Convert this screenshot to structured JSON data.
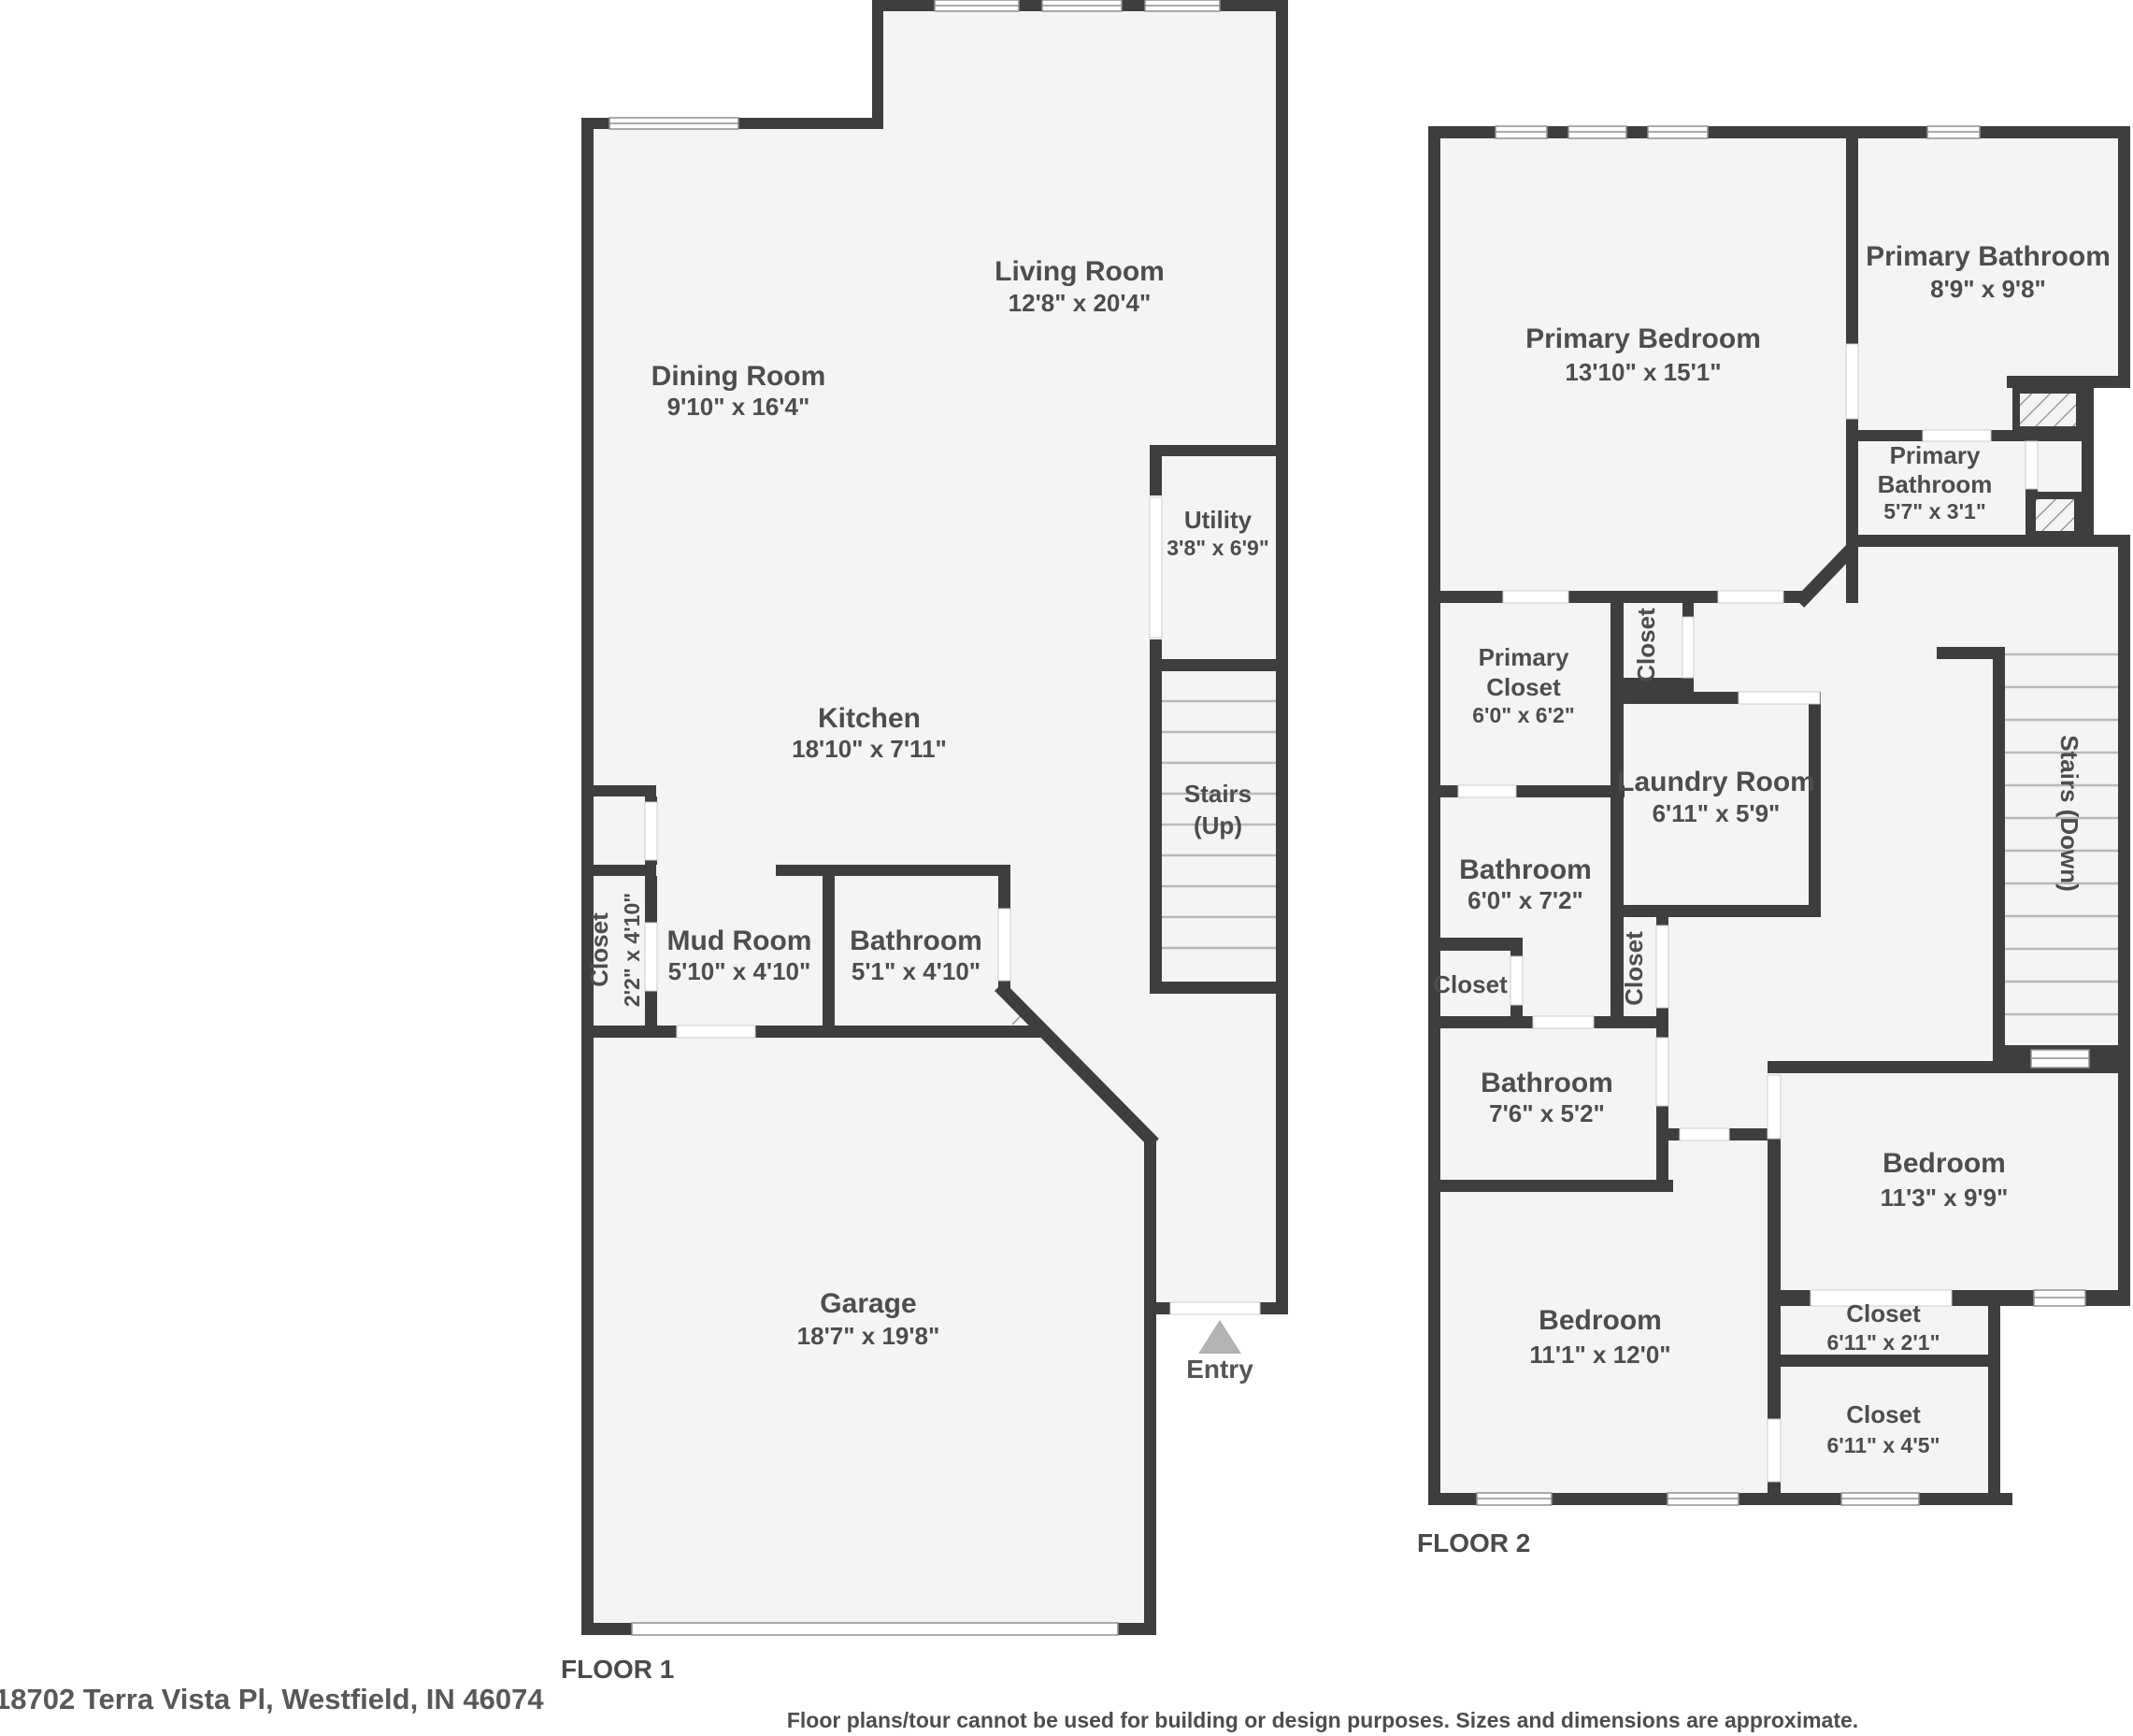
{
  "floor1": {
    "label": "FLOOR 1",
    "rooms": {
      "living": {
        "name": "Living Room",
        "dims": "12'8\" x 20'4\""
      },
      "dining": {
        "name": "Dining Room",
        "dims": "9'10\" x 16'4\""
      },
      "kitchen": {
        "name": "Kitchen",
        "dims": "18'10\" x 7'11\""
      },
      "utility": {
        "name": "Utility",
        "dims": "3'8\" x 6'9\""
      },
      "stairs": {
        "line1": "Stairs",
        "line2": "(Up)"
      },
      "closet": {
        "name": "Closet",
        "dims": "2'2\" x 4'10\""
      },
      "mud": {
        "name": "Mud Room",
        "dims": "5'10\" x 4'10\""
      },
      "bath": {
        "name": "Bathroom",
        "dims": "5'1\" x 4'10\""
      },
      "garage": {
        "name": "Garage",
        "dims": "18'7\" x 19'8\""
      },
      "entry": {
        "name": "Entry"
      }
    }
  },
  "floor2": {
    "label": "FLOOR 2",
    "rooms": {
      "primary_bedroom": {
        "name": "Primary Bedroom",
        "dims": "13'10\" x 15'1\""
      },
      "primary_bath1": {
        "name": "Primary Bathroom",
        "dims": "8'9\" x 9'8\""
      },
      "primary_bath2": {
        "line1": "Primary",
        "line2": "Bathroom",
        "dims": "5'7\" x 3'1\""
      },
      "primary_closet": {
        "line1": "Primary",
        "line2": "Closet",
        "dims": "6'0\" x 6'2\""
      },
      "closet_upper": {
        "name": "Closet"
      },
      "laundry": {
        "name": "Laundry Room",
        "dims": "6'11\" x 5'9\""
      },
      "bath_mid": {
        "name": "Bathroom",
        "dims": "6'0\" x 7'2\""
      },
      "closet_small": {
        "name": "Closet"
      },
      "closet_lower": {
        "name": "Closet"
      },
      "stairs": {
        "name": "Stairs (Down)"
      },
      "bath_lower": {
        "name": "Bathroom",
        "dims": "7'6\" x 5'2\""
      },
      "bedroom_left": {
        "name": "Bedroom",
        "dims": "11'1\" x 12'0\""
      },
      "bedroom_right": {
        "name": "Bedroom",
        "dims": "11'3\" x 9'9\""
      },
      "closet1": {
        "name": "Closet",
        "dims": "6'11\" x 2'1\""
      },
      "closet2": {
        "name": "Closet",
        "dims": "6'11\" x 4'5\""
      }
    }
  },
  "footer": {
    "address": "18702 Terra Vista Pl, Westfield, IN 46074",
    "disclaimer": "Floor plans/tour cannot be used for building or design purposes. Sizes and dimensions are approximate."
  },
  "colors": {
    "wall": "#3e3e3e",
    "floor": "#f4f4f4",
    "text": "#4d4d4d",
    "entry_triangle": "#b3b3b3"
  }
}
